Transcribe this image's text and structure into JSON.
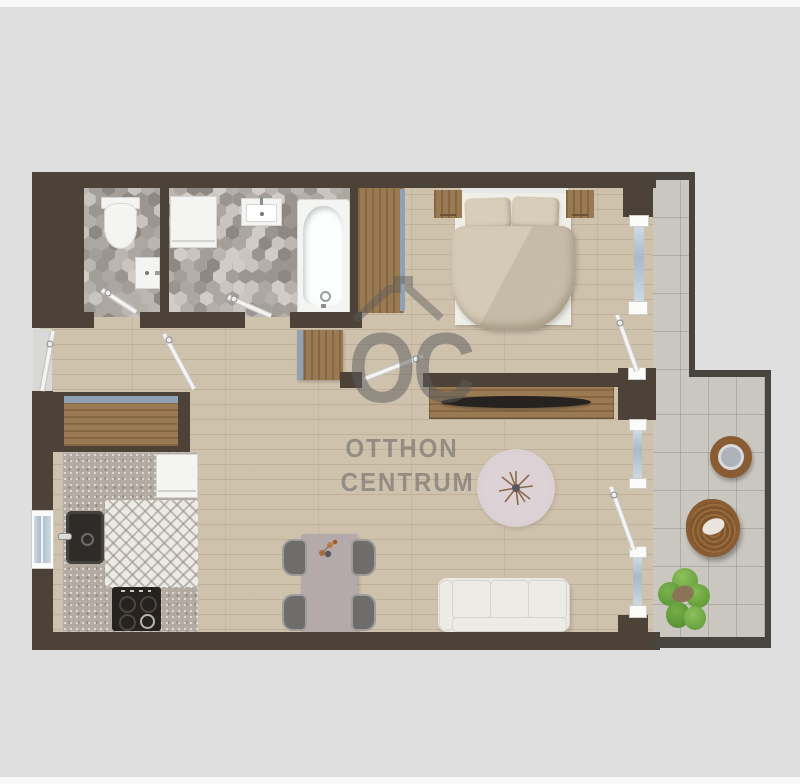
{
  "watermark": {
    "logo": "OC",
    "line1": "OTTHON",
    "line2": "CENTRUM"
  },
  "palette": {
    "background": "#dfdfe0",
    "page_strip": "#f8f8f8",
    "wall": "#4d4237",
    "balcony_wall": "#48443e",
    "wood_floor": "#cfc2ad",
    "balcony_tile": "#cac7c1",
    "kitchen_tile": "#eceae6",
    "counter": "#b3aaa2",
    "accent_blue": "#8fa2b5",
    "window_glass": "#a8b9c9",
    "fixture_white": "#f4f4f2",
    "furniture_wood": "#9a7a52",
    "duvet": "#ccc2ae",
    "sofa": "#ebe9e4",
    "rug": "#d8ced1",
    "dining_table": "#b4aaac",
    "chair": "#6e6d6b",
    "rattan": "#8a5c33",
    "plant": "#6fa944",
    "tv": "#26221f",
    "door_leaf": "#f4f3f1",
    "hex_tiles": [
      "#c9c4c0",
      "#bcb6b2",
      "#ada7a2",
      "#9b958f",
      "#8e8882",
      "#d1ccc8",
      "#b5afaa",
      "#a49e99"
    ]
  }
}
